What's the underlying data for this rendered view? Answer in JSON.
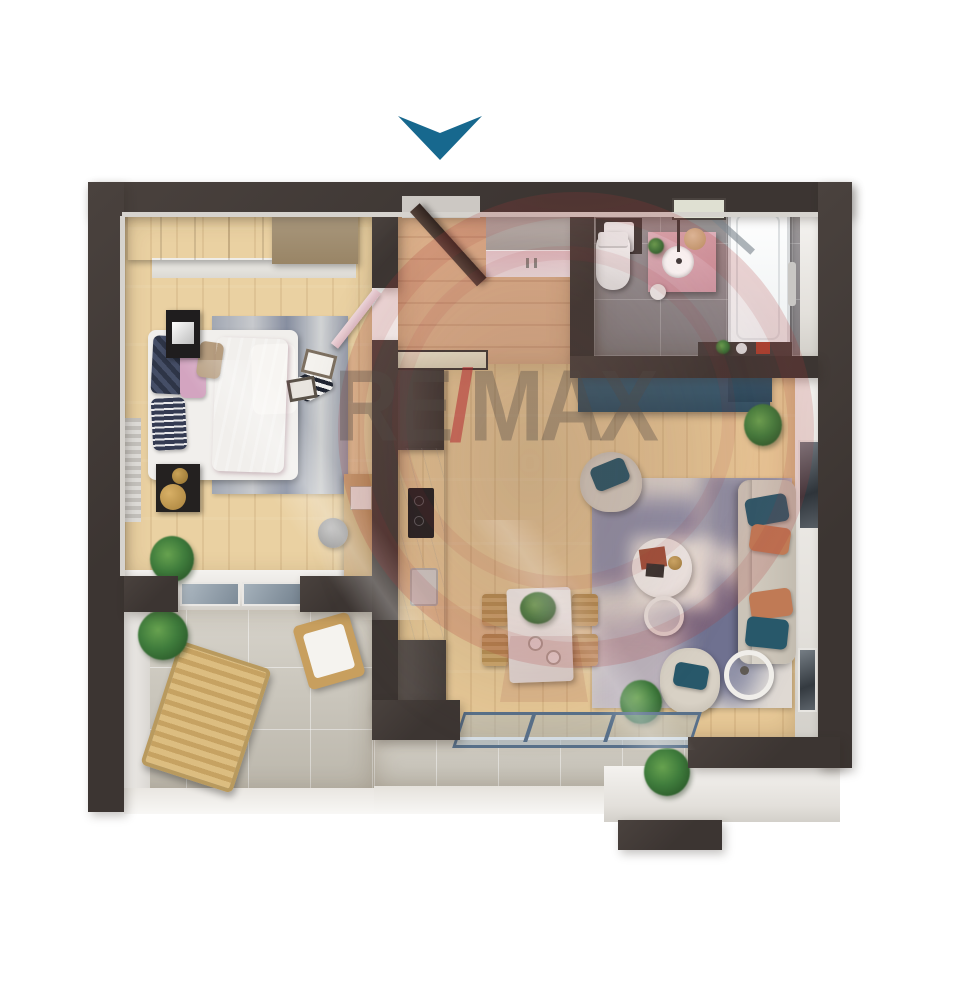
{
  "scene": {
    "type": "apartment-floor-plan-3d-render",
    "background": "#ffffff",
    "visible_text": "RE/MAX"
  },
  "entrance_marker": {
    "icon": "chevron-down-arrow",
    "color": "#17688e"
  },
  "watermark": {
    "brand": "RE/MAX",
    "left": "RE",
    "slash": "/",
    "right": "MAX",
    "slash_color": "#b23a40",
    "balloon_color": "#a82e34"
  },
  "palette": {
    "wall": "#3c3532",
    "wallFace": "#4a423e",
    "trim": "#d6d3ce",
    "woodBedroom": "#ead1a2",
    "woodHall": "#dfb28c",
    "woodLiving": "#e8c997",
    "tileBath": "#908c8f",
    "pinkVanity": "#d8a9b3",
    "tileBalcony": "#c7c2b6",
    "teal": "#31576a",
    "sofa": "#cec7bb",
    "pillowTeal": "#28586a",
    "pillowRust": "#c07a55",
    "bedPink": "#d2a4b8",
    "rugBlue": "#8d90a8",
    "plant": "#3f7c3c",
    "glass": "#9fb3c2",
    "white": "#f2f0ed",
    "arrow": "#17688e",
    "remaxRed": "#b23a40"
  },
  "rooms": [
    {
      "name": "bedroom"
    },
    {
      "name": "entrance-hall"
    },
    {
      "name": "bathroom"
    },
    {
      "name": "living-room-with-kitchen"
    },
    {
      "name": "balcony-terrace"
    }
  ],
  "furniture_inventory": [
    "wardrobe",
    "double-bed",
    "nightstand-tv",
    "desk",
    "pouf",
    "bedroom-rug",
    "entrance-door",
    "hall-cabinet",
    "kitchen-counter",
    "cooktop",
    "dining-table",
    "dining-chairs",
    "teal-sideboard",
    "sofa",
    "armchairs",
    "coffee-table",
    "side-table",
    "floor-lamp",
    "living-rug",
    "toilet",
    "vanity-sink",
    "bathtub",
    "shower-screen",
    "washing-machine",
    "sun-lounger",
    "balcony-chair",
    "plants",
    "windows",
    "sliding-glass-doors"
  ]
}
